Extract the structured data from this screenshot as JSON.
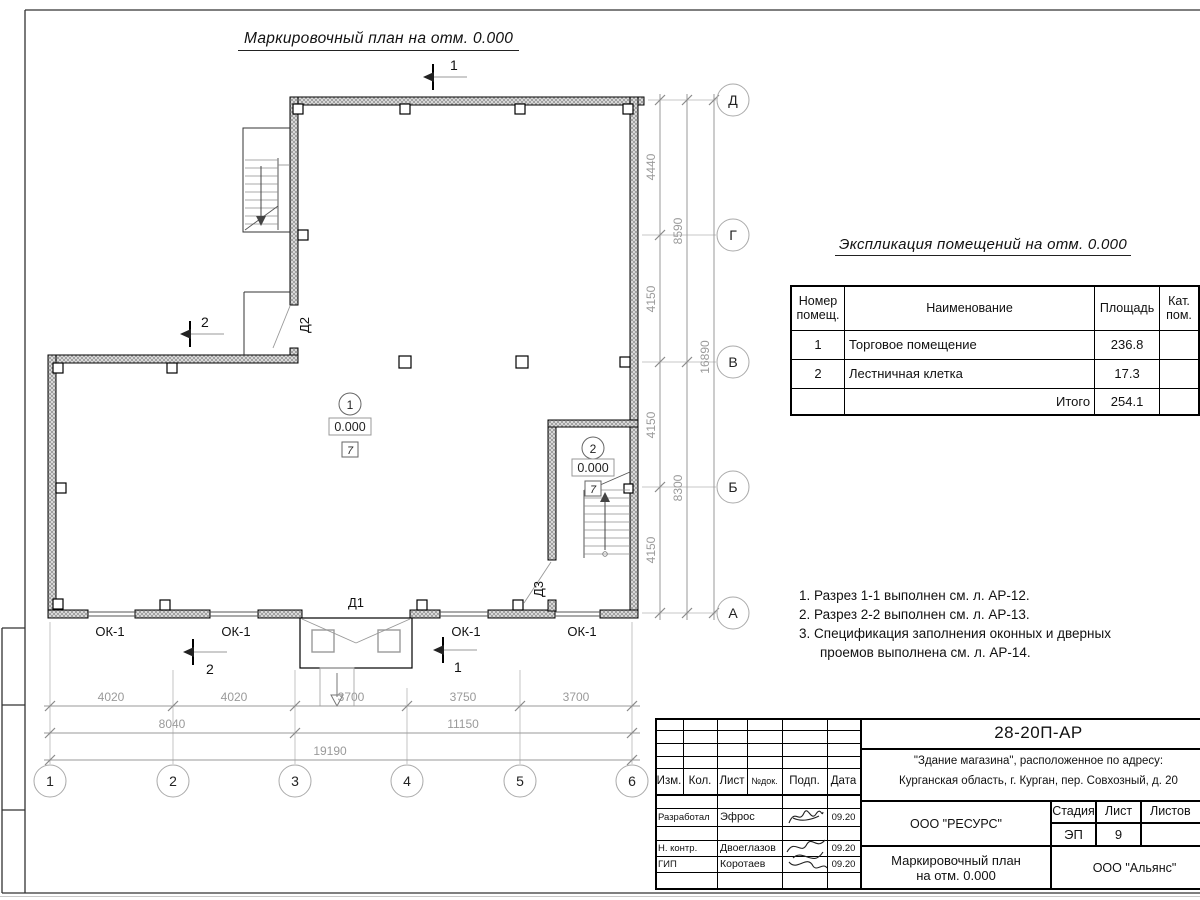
{
  "sheet": {
    "plan_title": "Маркировочный план на отм. 0.000"
  },
  "plan": {
    "axes_bottom": [
      "1",
      "2",
      "3",
      "4",
      "5",
      "6"
    ],
    "axes_right": [
      "Д",
      "Г",
      "В",
      "Б",
      "А"
    ],
    "dims_bottom": {
      "row1": [
        "4020",
        "4020",
        "3700",
        "3750",
        "3700"
      ],
      "row2": [
        "8040",
        "11150"
      ],
      "total": "19190"
    },
    "dims_right": {
      "row1": [
        "4440",
        "4150",
        "4150",
        "4150"
      ],
      "row2": [
        "8590",
        "8300"
      ],
      "total": "16890"
    },
    "window_label": "ОК-1",
    "doors": {
      "d1": "Д1",
      "d2": "Д2",
      "d3": "Д3"
    },
    "rooms": [
      {
        "number": "1",
        "elevation": "0.000",
        "floor_type": "7"
      },
      {
        "number": "2",
        "elevation": "0.000",
        "floor_type": "7"
      }
    ],
    "sections": {
      "s1": "1",
      "s2": "2"
    }
  },
  "explication": {
    "title": "Экспликация помещений на отм. 0.000",
    "headers": {
      "number": "Номер помещ.",
      "name": "Наименование",
      "area": "Площадь",
      "category": "Кат. пом."
    },
    "rows": [
      {
        "number": "1",
        "name": "Торговое помещение",
        "area": "236.8",
        "category": ""
      },
      {
        "number": "2",
        "name": "Лестничная клетка",
        "area": "17.3",
        "category": ""
      }
    ],
    "total_label": "Итого",
    "total_area": "254.1"
  },
  "notes": {
    "line1": "1. Разрез 1-1 выполнен см. л. АР-12.",
    "line2": "2. Разрез 2-2 выполнен см. л. АР-13.",
    "line3": "3. Спецификация заполнения оконных и дверных",
    "line4": "проемов выполнена см. л. АР-14."
  },
  "titleblock": {
    "doc_number": "28-20П-АР",
    "project_line1": "\"Здание магазина\", расположенное по адресу:",
    "project_line2": "Курганская область, г. Курган, пер. Совхозный, д. 20",
    "change_headers": {
      "izm": "Изм.",
      "kol": "Кол.",
      "list": "Лист",
      "doc": "№док.",
      "sign": "Подп.",
      "date": "Дата"
    },
    "roles": [
      {
        "role": "Разработал",
        "name": "Эфрос",
        "date": "09.20"
      },
      {
        "role": "Н. контр.",
        "name": "Двоеглазов",
        "date": "09.20"
      },
      {
        "role": "ГИП",
        "name": "Коротаев",
        "date": "09.20"
      }
    ],
    "designer_org": "ООО \"РЕСУРС\"",
    "stage_header": "Стадия",
    "sheet_header": "Лист",
    "sheets_header": "Листов",
    "stage": "ЭП",
    "sheet_number": "9",
    "drawing_title_line1": "Маркировочный план",
    "drawing_title_line2": "на отм. 0.000",
    "client_org": "ООО \"Альянс\""
  }
}
